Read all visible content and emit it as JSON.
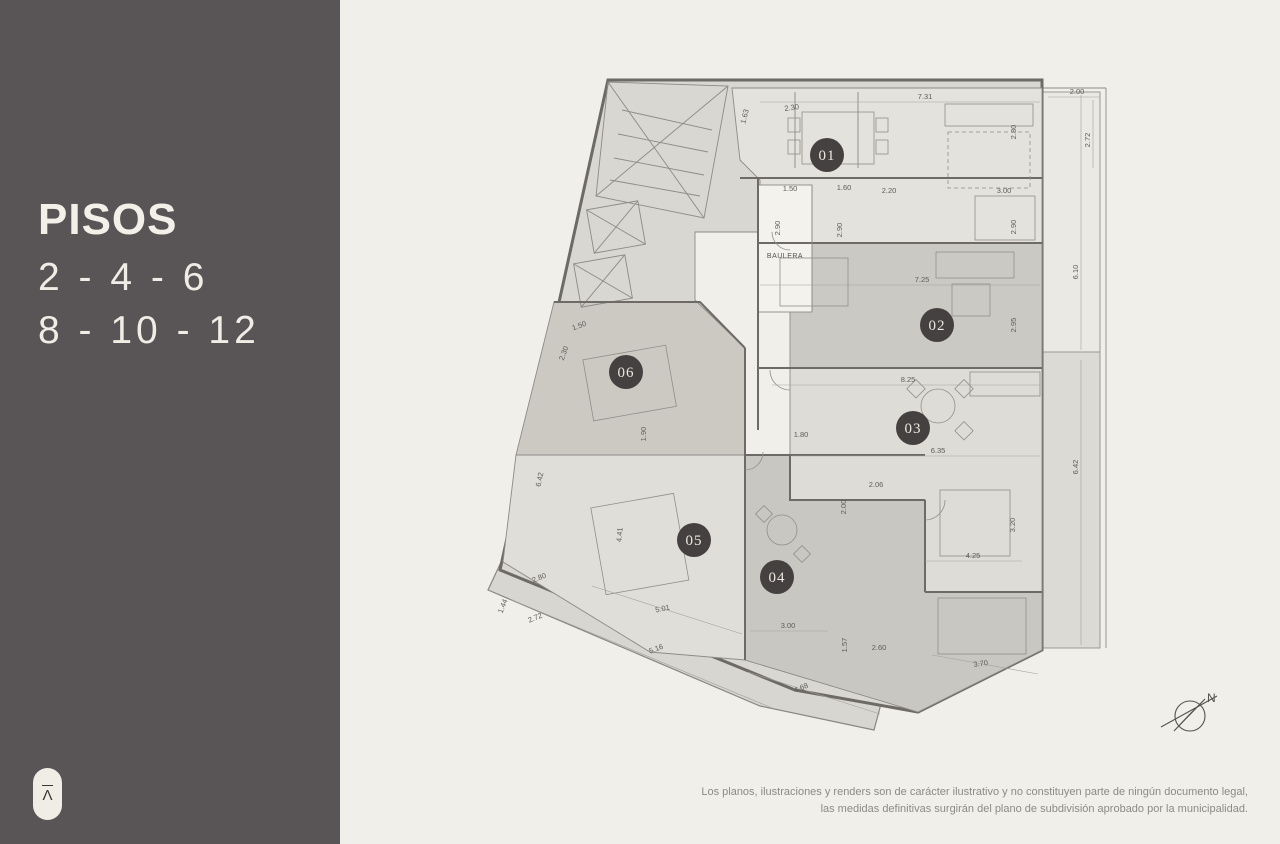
{
  "sidebar": {
    "title": "PISOS",
    "floors_line1": "2 - 4 - 6",
    "floors_line2": "8 - 10 - 12",
    "logo_glyph": "Λ"
  },
  "plan": {
    "units": [
      {
        "id": "01",
        "label": "01"
      },
      {
        "id": "02",
        "label": "02"
      },
      {
        "id": "03",
        "label": "03"
      },
      {
        "id": "04",
        "label": "04"
      },
      {
        "id": "05",
        "label": "05"
      },
      {
        "id": "06",
        "label": "06"
      }
    ],
    "room_labels": {
      "baulera": "BAULERA"
    },
    "compass_label": "N",
    "dimensions": [
      {
        "text": "1.63"
      },
      {
        "text": "2.30"
      },
      {
        "text": "7.31"
      },
      {
        "text": "2.80"
      },
      {
        "text": "2.00"
      },
      {
        "text": "2.72"
      },
      {
        "text": "1.50"
      },
      {
        "text": "1.60"
      },
      {
        "text": "2.20"
      },
      {
        "text": "3.00"
      },
      {
        "text": "2.90"
      },
      {
        "text": "2.90"
      },
      {
        "text": "2.90"
      },
      {
        "text": "7.25"
      },
      {
        "text": "2.95"
      },
      {
        "text": "6.10"
      },
      {
        "text": "8.25"
      },
      {
        "text": "1.80"
      },
      {
        "text": "6.35"
      },
      {
        "text": "2.06"
      },
      {
        "text": "2.00"
      },
      {
        "text": "3.20"
      },
      {
        "text": "4.25"
      },
      {
        "text": "6.42"
      },
      {
        "text": "1.50"
      },
      {
        "text": "2.30"
      },
      {
        "text": "1.90"
      },
      {
        "text": "6.42"
      },
      {
        "text": "4.41"
      },
      {
        "text": "2.80"
      },
      {
        "text": "1.44"
      },
      {
        "text": "2.72"
      },
      {
        "text": "5.01"
      },
      {
        "text": "5.16"
      },
      {
        "text": "3.00"
      },
      {
        "text": "1.57"
      },
      {
        "text": "2.60"
      },
      {
        "text": "4.68"
      },
      {
        "text": "3.70"
      }
    ]
  },
  "footer": {
    "disclaimer_line1": "Los planos, ilustraciones y renders son de carácter ilustrativo y no constituyen parte de ningún documento legal,",
    "disclaimer_line2": "las medidas definitivas surgirán del plano de subdivisión aprobado por la municipalidad."
  },
  "colors": {
    "sidebar": "#595556",
    "background": "#f0efea",
    "badge": "#454140",
    "badge_text": "#ece8e1",
    "wall_line": "#6e6a67",
    "dimension_text": "#605d5a",
    "unit_fills": {
      "u01": "#e4e2dc",
      "u02": "#cbc9c3",
      "u03": "#dedcd6",
      "u04": "#c9c7c1",
      "u05": "#e0ded8",
      "u06": "#ccc9c3",
      "balcony_top": "#ebe9e3",
      "balcony_bottom": "#dcdad4",
      "terrace": "#d8d6d0"
    }
  }
}
